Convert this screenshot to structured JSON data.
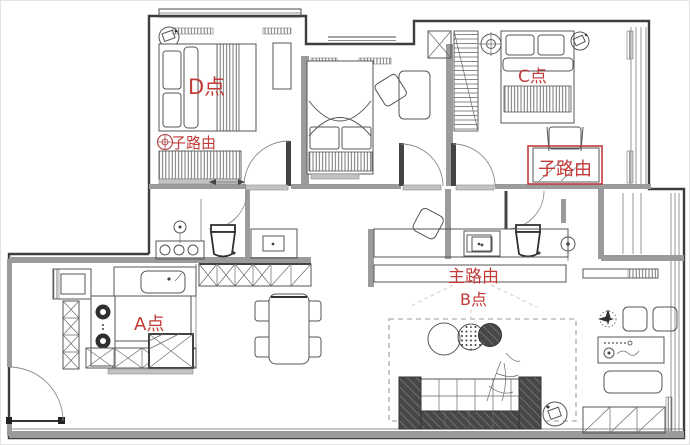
{
  "title": "apartment-floor-plan-with-wifi-router-points",
  "annotations": {
    "point_d": "D点",
    "point_c": "C点",
    "point_a": "A点",
    "point_b": "B点",
    "main_router": "主路由",
    "sub_router_bedroom_d": "子路由",
    "sub_router_bedroom_c": "子路由"
  },
  "colors": {
    "annotation_red": "#c23b38",
    "wall": "#3d3d3d",
    "furniture_line": "#555555",
    "gray_fill": "#9b9b9b"
  }
}
